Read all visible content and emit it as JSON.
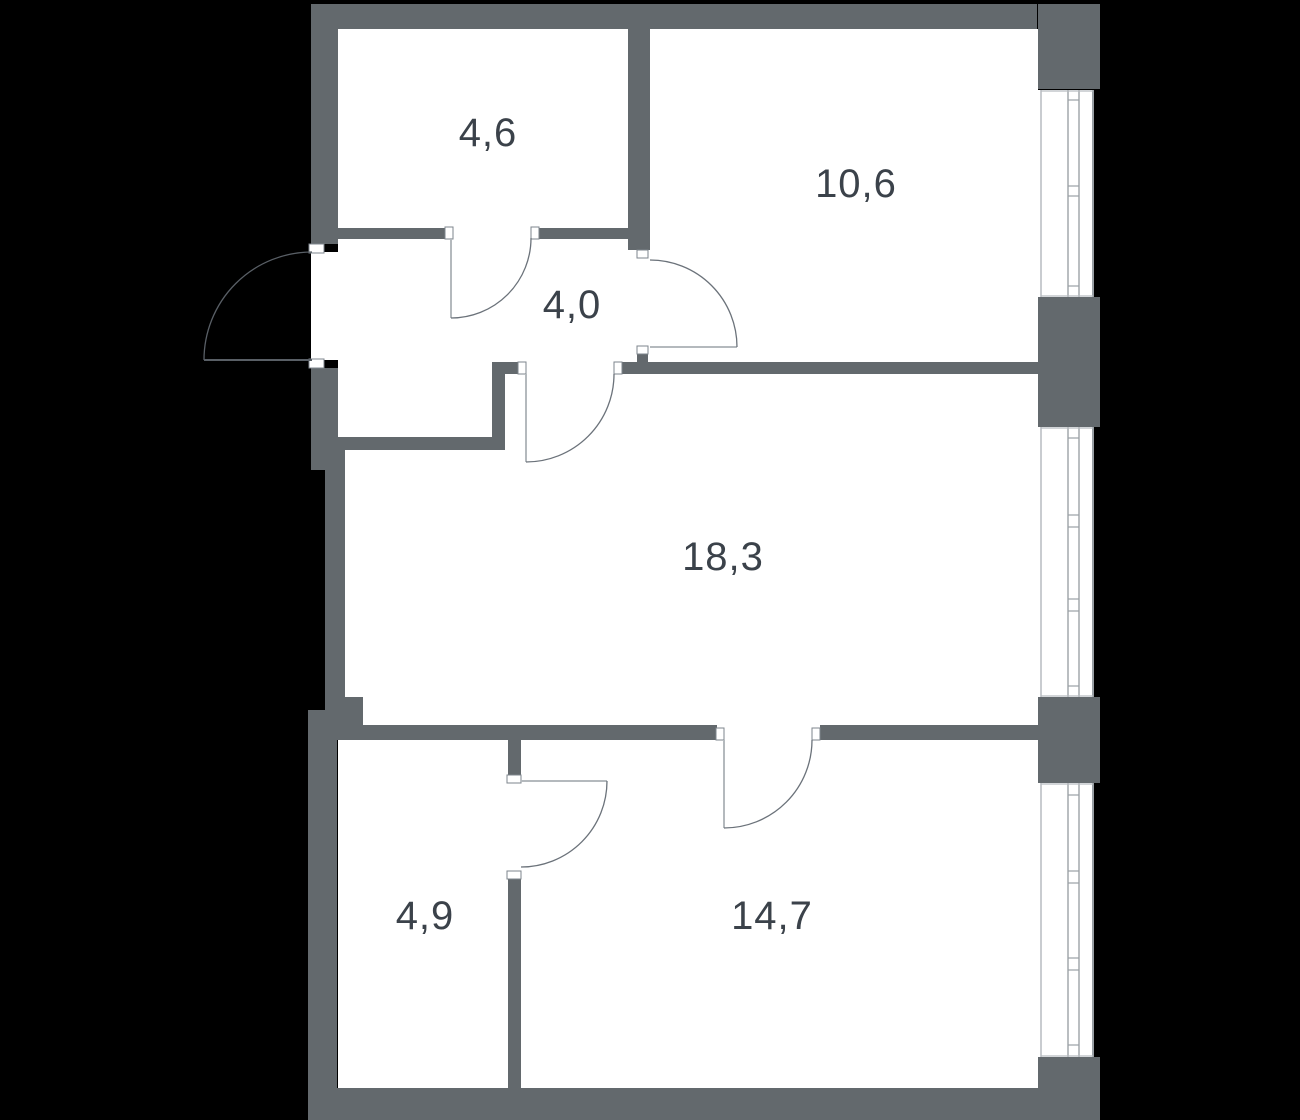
{
  "title": "Apartment floor plan",
  "rooms": [
    {
      "id": "room-4-6",
      "area": "4,6",
      "x": 488,
      "y": 133
    },
    {
      "id": "room-10-6",
      "area": "10,6",
      "x": 856,
      "y": 184
    },
    {
      "id": "hall-4-0",
      "area": "4,0",
      "x": 572,
      "y": 305
    },
    {
      "id": "room-18-3",
      "area": "18,3",
      "x": 723,
      "y": 557
    },
    {
      "id": "room-4-9",
      "area": "4,9",
      "x": 425,
      "y": 916
    },
    {
      "id": "room-14-7",
      "area": "14,7",
      "x": 772,
      "y": 916
    }
  ],
  "colors": {
    "background": "#000000",
    "wall": "#63696d",
    "room_fill": "#ffffff",
    "label": "#3b424a",
    "door_arc": "#6b727a",
    "door_leaf": "#b4b9bd",
    "entry_door": "#595f66",
    "jamb_border": "#7e858c",
    "window_line": "#8d9398",
    "window_light_line": "#b7bcc0",
    "window_edge": "#9aa0a5"
  },
  "geometry": {
    "canvas": {
      "w": 1300,
      "h": 1120
    },
    "white_areas": [
      [
        338,
        29,
        700,
        1059
      ],
      [
        311,
        252,
        27,
        108
      ],
      [
        1038,
        90,
        56,
        207
      ],
      [
        1038,
        427,
        56,
        270
      ],
      [
        1038,
        783,
        56,
        274
      ]
    ],
    "walls": [
      [
        313,
        4,
        724,
        25
      ],
      [
        1038,
        4,
        62,
        85
      ],
      [
        311,
        4,
        27,
        240
      ],
      [
        311,
        368,
        27,
        102
      ],
      [
        325,
        450,
        20,
        262
      ],
      [
        325,
        697,
        38,
        33
      ],
      [
        308,
        710,
        29,
        410
      ],
      [
        308,
        1088,
        792,
        32
      ],
      [
        1038,
        297,
        62,
        130
      ],
      [
        1038,
        697,
        62,
        86
      ],
      [
        1038,
        1057,
        62,
        63
      ],
      [
        628,
        29,
        22,
        221
      ],
      [
        338,
        228,
        107,
        11
      ],
      [
        537,
        228,
        91,
        11
      ],
      [
        637,
        354,
        11,
        10
      ],
      [
        622,
        362,
        416,
        12
      ],
      [
        492,
        362,
        26,
        12
      ],
      [
        492,
        374,
        13,
        76
      ],
      [
        338,
        437,
        167,
        13
      ],
      [
        337,
        725,
        380,
        15
      ],
      [
        820,
        725,
        218,
        15
      ],
      [
        508,
        740,
        13,
        36
      ],
      [
        508,
        879,
        13,
        209
      ]
    ],
    "jambs": [
      [
        309,
        244,
        15,
        9
      ],
      [
        309,
        359,
        15,
        9
      ],
      [
        445,
        227,
        8,
        12
      ],
      [
        531,
        227,
        8,
        12
      ],
      [
        637,
        250,
        11,
        8
      ],
      [
        637,
        346,
        11,
        8
      ],
      [
        518,
        362,
        8,
        12
      ],
      [
        614,
        362,
        8,
        12
      ],
      [
        716,
        728,
        8,
        12
      ],
      [
        812,
        728,
        8,
        12
      ],
      [
        507,
        775,
        14,
        8
      ],
      [
        507,
        871,
        14,
        8
      ]
    ],
    "doors": [
      {
        "name": "entry-door",
        "tone": "entry",
        "leaf": [
          204,
          360,
          312,
          360
        ],
        "arc": "M312,252 A108,108 0 0 0 204,360"
      },
      {
        "name": "door-room-4-6",
        "tone": "interior",
        "leaf": [
          451,
          238,
          451,
          318
        ],
        "arc": "M451,318 A80,80 0 0 0 531,238"
      },
      {
        "name": "door-room-10-6",
        "tone": "interior",
        "leaf": [
          650,
          347,
          737,
          347
        ],
        "arc": "M737,347 A87,87 0 0 0 650,260"
      },
      {
        "name": "door-room-18-3",
        "tone": "interior",
        "leaf": [
          526,
          374,
          526,
          462
        ],
        "arc": "M526,462 A88,88 0 0 0 614,374"
      },
      {
        "name": "door-room-14-7",
        "tone": "interior",
        "leaf": [
          724,
          740,
          724,
          828
        ],
        "arc": "M724,828 A88,88 0 0 0 812,740"
      },
      {
        "name": "door-room-4-9",
        "tone": "interior",
        "leaf": [
          521,
          781,
          607,
          781
        ],
        "arc": "M607,781 A86,86 0 0 1 521,867"
      }
    ],
    "windows": [
      {
        "name": "window-room-10-6",
        "y0": 90,
        "y1": 297,
        "ticks": [
          100,
          186,
          196,
          286
        ]
      },
      {
        "name": "window-room-18-3",
        "y0": 427,
        "y1": 697,
        "ticks": [
          438,
          515,
          527,
          599,
          611,
          686
        ]
      },
      {
        "name": "window-room-14-7",
        "y0": 783,
        "y1": 1057,
        "ticks": [
          795,
          871,
          883,
          958,
          970,
          1045
        ]
      }
    ],
    "window_x": {
      "zone_left": 1038,
      "inner": 1041,
      "glaze1": 1068,
      "glaze2": 1079,
      "edge": 1093
    }
  }
}
